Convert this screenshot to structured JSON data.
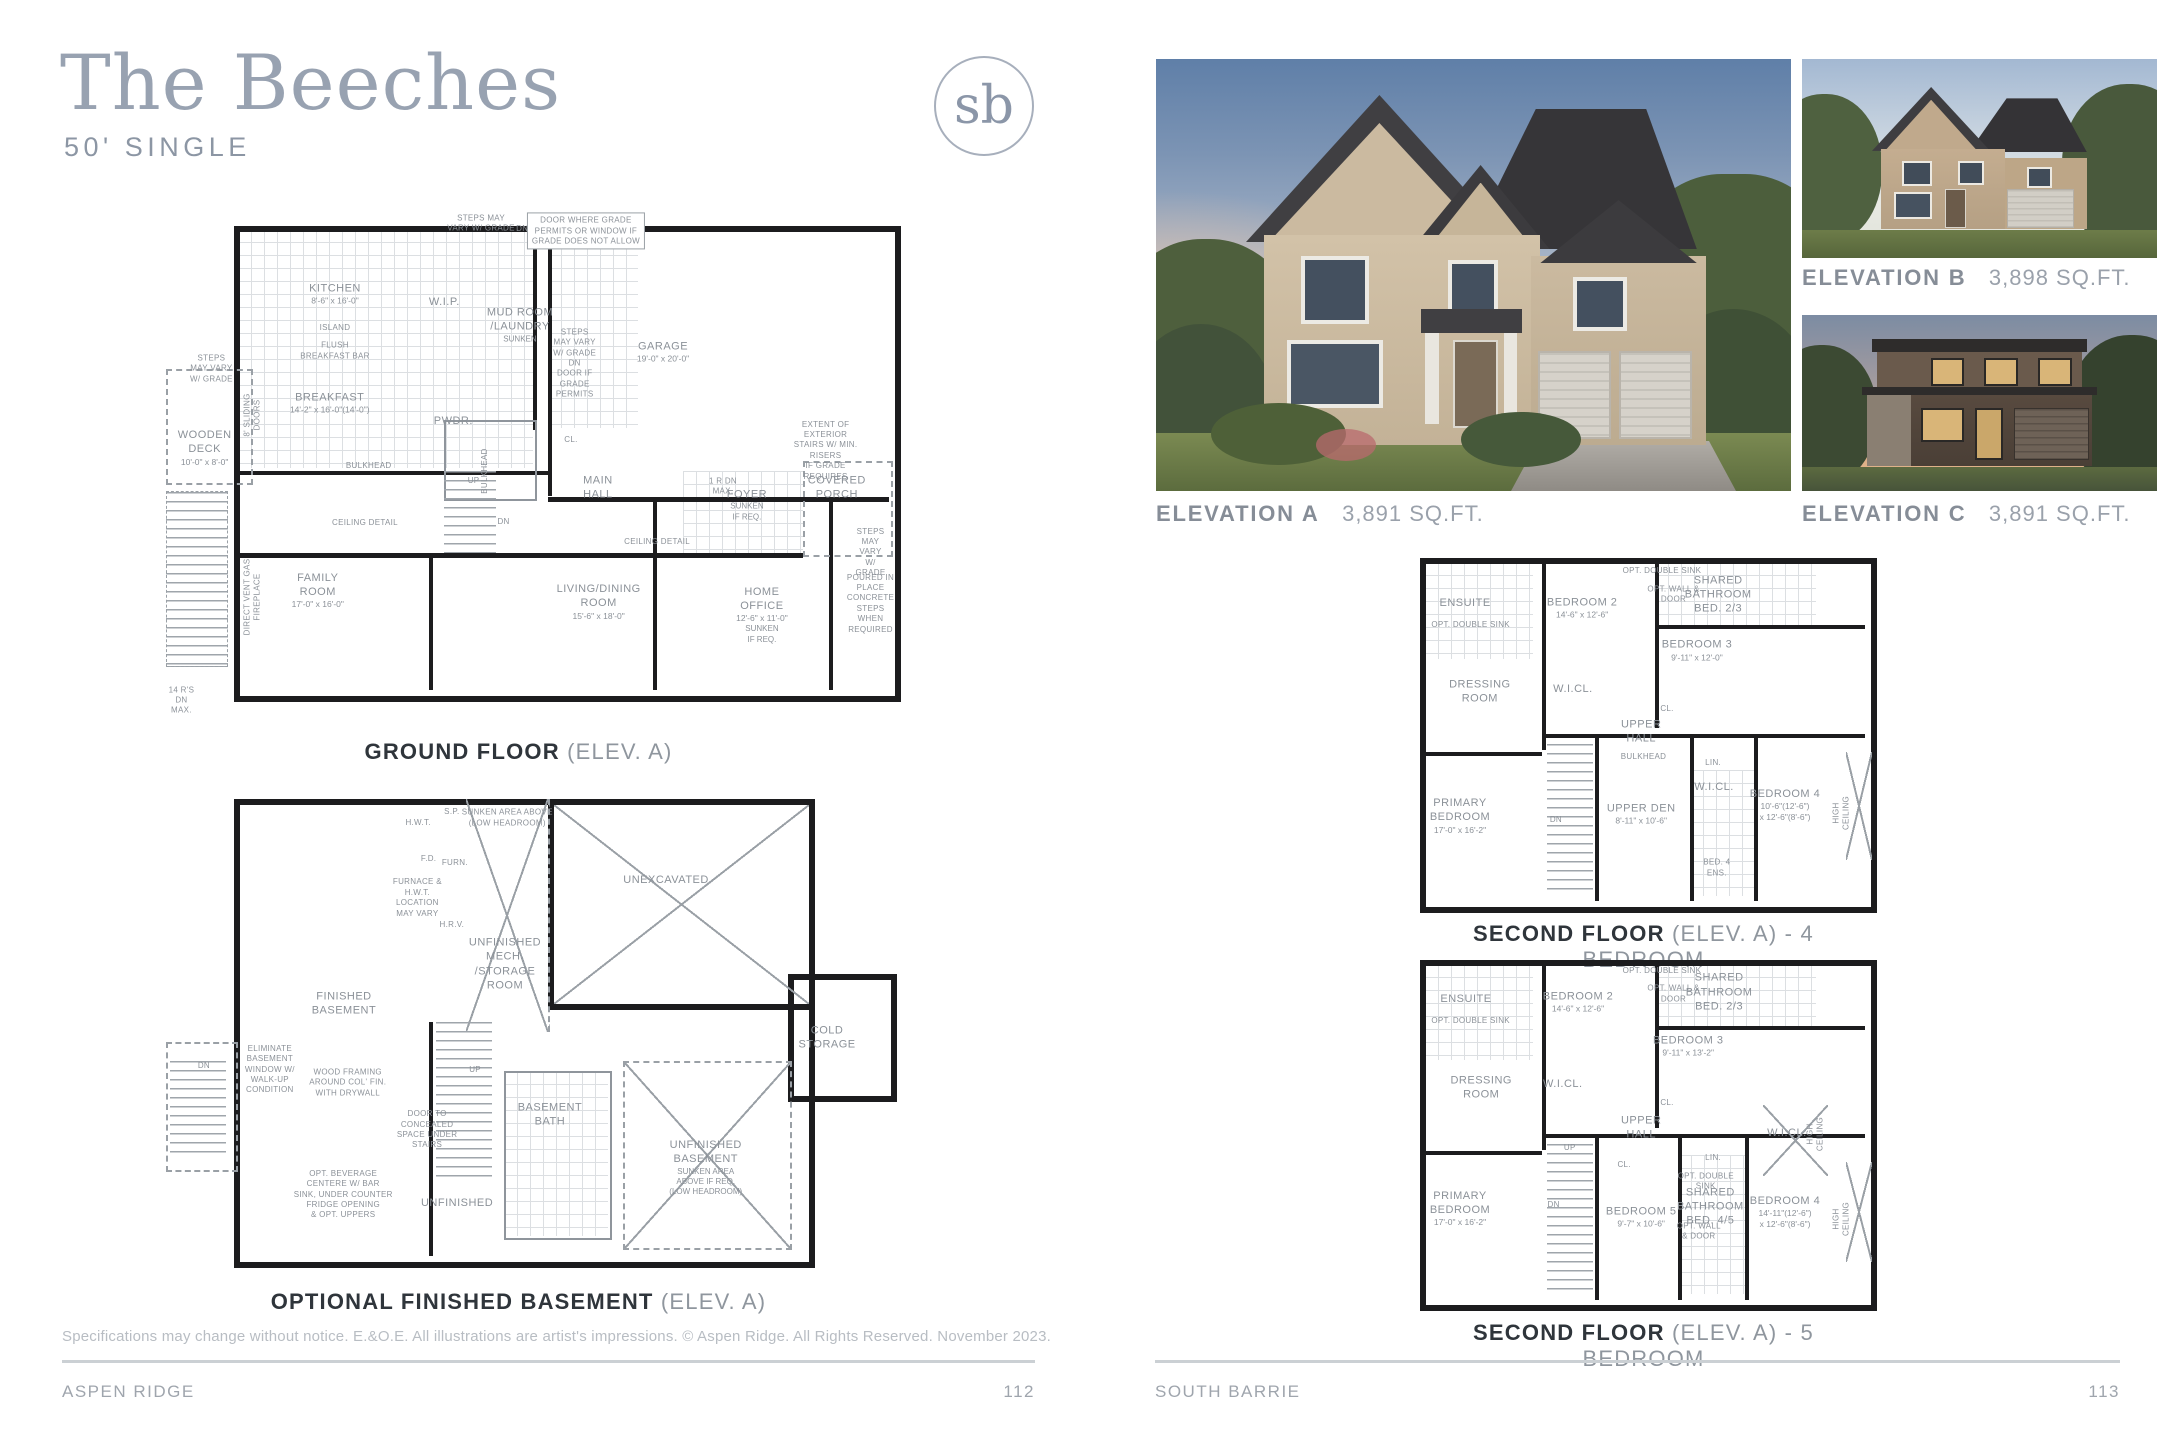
{
  "page": {
    "title": "The Beeches",
    "subtitle": "50' SINGLE",
    "logo_text": "sb",
    "disclaimer": "Specifications may change without notice. E.&O.E. All illustrations are artist's impressions. © Aspen Ridge. All Rights Reserved. November 2023.",
    "footer_left": {
      "label": "ASPEN RIDGE",
      "page": "112"
    },
    "footer_right": {
      "label": "SOUTH BARRIE",
      "page": "113"
    }
  },
  "colors": {
    "accent": "#98a2b1",
    "caption_dark": "#2f353b",
    "caption_gray": "#8f969e",
    "wall": "#1c1c1e"
  },
  "elevations": [
    {
      "id": "A",
      "label": "ELEVATION A",
      "sqft": "3,891 SQ.FT."
    },
    {
      "id": "B",
      "label": "ELEVATION B",
      "sqft": "3,898 SQ.FT."
    },
    {
      "id": "C",
      "label": "ELEVATION C",
      "sqft": "3,891 SQ.FT."
    }
  ],
  "plans": {
    "ground_floor": {
      "caption_bold": "GROUND FLOOR",
      "caption_light": "(ELEV. A)",
      "labels": [
        {
          "t": "KITCHEN",
          "d": "8'-6\" x 16'-0\"",
          "x": 25.5,
          "y": 15.3
        },
        {
          "t": "ISLAND",
          "x": 25.5,
          "y": 22,
          "s": "sm"
        },
        {
          "t": "FLUSH\nBREAKFAST BAR",
          "x": 25.5,
          "y": 26.5,
          "s": "sm"
        },
        {
          "t": "W.I.P.",
          "x": 40.1,
          "y": 16.9
        },
        {
          "t": "MUD ROOM\n/LAUNDRY",
          "n": "SUNKEN",
          "x": 50.2,
          "y": 21.4
        },
        {
          "t": "GARAGE",
          "d": "19'-0\" x 20'-0\"",
          "x": 69.3,
          "y": 26.7
        },
        {
          "t": "BREAKFAST",
          "d": "14'-2\" x 16'-0\"(14'-0\")",
          "x": 24.8,
          "y": 36.7
        },
        {
          "t": "WOODEN\nDECK",
          "d": "10'-0\" x 8'-0\"",
          "x": 8.1,
          "y": 45.5
        },
        {
          "t": "PWDR.",
          "x": 41.3,
          "y": 40.2
        },
        {
          "t": "CL.",
          "x": 57,
          "y": 44,
          "s": "sm"
        },
        {
          "t": "MAIN\nHALL",
          "x": 60.6,
          "y": 53.3
        },
        {
          "t": "FOYER",
          "n": "SUNKEN\nIF REQ.",
          "x": 80.5,
          "y": 56.7
        },
        {
          "t": "COVERED\nPORCH",
          "x": 92.5,
          "y": 53.3
        },
        {
          "t": "FAMILY\nROOM",
          "d": "17'-0\" x 16'-0\"",
          "x": 23.2,
          "y": 73.5
        },
        {
          "t": "LIVING/DINING\nROOM",
          "d": "15'-6\" x 18'-0\"",
          "x": 60.7,
          "y": 75.7
        },
        {
          "t": "HOME\nOFFICE",
          "d": "12'-6\" x 11'-0\"",
          "n": "SUNKEN\nIF REQ.",
          "x": 82.5,
          "y": 78.2
        },
        {
          "t": "STEPS MAY\nVARY W/ GRADE",
          "x": 45,
          "y": 1.5,
          "s": "sm"
        },
        {
          "t": "DN",
          "x": 50.5,
          "y": 2.5,
          "s": "sm"
        },
        {
          "t": "DOOR WHERE GRADE\nPERMITS OR WINDOW IF\nGRADE DOES NOT ALLOW",
          "x": 59,
          "y": 3,
          "s": "sm",
          "b": true
        },
        {
          "t": "STEPS\nMAY VARY\nW/ GRADE",
          "x": 9,
          "y": 30,
          "s": "sm"
        },
        {
          "t": "STEPS\nMAY VARY\nW/ GRADE\nDN\nDOOR IF\nGRADE\nPERMITS",
          "x": 57.5,
          "y": 29,
          "s": "sm"
        },
        {
          "t": "8' SLIDING\nDOORS",
          "x": 14.5,
          "y": 39,
          "s": "sm",
          "r": true
        },
        {
          "t": "BULKHEAD",
          "x": 45.5,
          "y": 50,
          "s": "sm",
          "r": true
        },
        {
          "t": "UP",
          "x": 44,
          "y": 52,
          "s": "sm"
        },
        {
          "t": "DN",
          "x": 48,
          "y": 60,
          "s": "sm"
        },
        {
          "t": "1 R DN\nMAX.",
          "x": 77.3,
          "y": 53.1,
          "s": "sm"
        },
        {
          "t": "CEILING DETAIL",
          "x": 29.5,
          "y": 60.2,
          "s": "sm"
        },
        {
          "t": "CEILING DETAIL",
          "x": 68.5,
          "y": 63.9,
          "s": "sm"
        },
        {
          "t": "DIRECT VENT GAS\nFIREPLACE",
          "x": 14.6,
          "y": 74.7,
          "s": "sm",
          "r": true
        },
        {
          "t": "EXTENT OF EXTERIOR\nSTAIRS W/ MIN. RISERS\nIF GRADE REQUIRES",
          "x": 91,
          "y": 46,
          "s": "sm"
        },
        {
          "t": "STEPS\nMAY VARY\nW/ GRADE",
          "x": 97,
          "y": 66,
          "s": "sm"
        },
        {
          "t": "POURED IN PLACE\nCONCRETE STEPS\nWHEN REQUIRED",
          "x": 97,
          "y": 76,
          "s": "sm"
        },
        {
          "t": "14 R'S\nDN\nMAX.",
          "x": 5,
          "y": 95,
          "s": "sm"
        },
        {
          "t": "BULKHEAD",
          "x": 30,
          "y": 49,
          "s": "sm"
        }
      ]
    },
    "basement": {
      "caption_bold": "OPTIONAL FINISHED BASEMENT",
      "caption_light": "(ELEV. A)",
      "labels": [
        {
          "t": "FINISHED\nBASEMENT",
          "x": 26.7,
          "y": 44.2
        },
        {
          "t": "UNFINISHED\nMECH.\n/STORAGE\nROOM",
          "x": 48.2,
          "y": 36
        },
        {
          "t": "SUNKEN AREA ABOVE\n(LOW HEADROOM)",
          "x": 48.5,
          "y": 6,
          "s": "sm"
        },
        {
          "t": "UNEXCAVATED",
          "x": 69.7,
          "y": 18.7
        },
        {
          "t": "COLD\nSTORAGE",
          "x": 91.2,
          "y": 51.2
        },
        {
          "t": "UNFINISHED\nBASEMENT",
          "n": "SUNKEN AREA\nABOVE IF REQ.\n(LOW HEADROOM)",
          "x": 75,
          "y": 78
        },
        {
          "t": "BASEMENT\nBATH",
          "x": 54.2,
          "y": 67
        },
        {
          "t": "UNFINISHED",
          "x": 41.8,
          "y": 85.2
        },
        {
          "t": "H.W.T.",
          "x": 36.6,
          "y": 7,
          "s": "sm"
        },
        {
          "t": "S.P.",
          "x": 41.1,
          "y": 4.7,
          "s": "sm"
        },
        {
          "t": "F.D.",
          "x": 38,
          "y": 14.4,
          "s": "sm"
        },
        {
          "t": "FURN.",
          "x": 41.5,
          "y": 15.2,
          "s": "sm"
        },
        {
          "t": "FURNACE &\nH.W.T.\nLOCATION\nMAY VARY",
          "x": 36.5,
          "y": 22.5,
          "s": "sm"
        },
        {
          "t": "H.R.V.",
          "x": 41.1,
          "y": 28,
          "s": "sm"
        },
        {
          "t": "UP",
          "x": 44.2,
          "y": 57.8,
          "s": "sm"
        },
        {
          "t": "WOOD FRAMING\nAROUND COL' FIN.\nWITH DRYWALL",
          "x": 27.2,
          "y": 60.5,
          "s": "sm"
        },
        {
          "t": "DOOR TO\nCONCEALED\nSPACE UNDER\nSTAIRS",
          "x": 37.8,
          "y": 70.2,
          "s": "sm"
        },
        {
          "t": "OPT. BEVERAGE\nCENTERE W/ BAR\nSINK, UNDER COUNTER\nFRIDGE OPENING\n& OPT. UPPERS",
          "x": 26.6,
          "y": 83.5,
          "s": "sm"
        },
        {
          "t": "ELIMINATE\nBASEMENT\nWINDOW W/\nWALK-UP\nCONDITION",
          "x": 16.8,
          "y": 57.8,
          "s": "sm"
        },
        {
          "t": "DN",
          "x": 8,
          "y": 57,
          "s": "sm"
        }
      ]
    },
    "second_4br": {
      "caption_bold": "SECOND FLOOR",
      "caption_light": "(ELEV. A) - 4 BEDROOM",
      "labels": [
        {
          "t": "ENSUITE",
          "x": 11.3,
          "y": 13.9
        },
        {
          "t": "OPT. DOUBLE SINK",
          "x": 12.5,
          "y": 20,
          "s": "sm"
        },
        {
          "t": "BEDROOM 2",
          "d": "14'-6\" x 12'-6\"",
          "x": 36.7,
          "y": 15.2
        },
        {
          "t": "OPT. DOUBLE SINK",
          "x": 54,
          "y": 5,
          "s": "sm"
        },
        {
          "t": "OPT. WALL &\nDOOR",
          "x": 56.5,
          "y": 11.5,
          "s": "sm"
        },
        {
          "t": "SHARED\nBATHROOM\nBED. 2/3",
          "x": 66.2,
          "y": 11.5
        },
        {
          "t": "BEDROOM 3",
          "d": "9'-11\" x 12'-0\"",
          "x": 61.6,
          "y": 27
        },
        {
          "t": "DRESSING\nROOM",
          "x": 14.5,
          "y": 38.5
        },
        {
          "t": "W.I.CL.",
          "x": 34.7,
          "y": 37.7
        },
        {
          "t": "CL.",
          "x": 55.1,
          "y": 43.2,
          "s": "sm"
        },
        {
          "t": "UPPER\nHALL",
          "x": 49.5,
          "y": 49.6
        },
        {
          "t": "PRIMARY\nBEDROOM",
          "d": "17'-0\" x 16'-2\"",
          "x": 10.2,
          "y": 72.9
        },
        {
          "t": "UPPER DEN",
          "d": "8'-11\" x 10'-6\"",
          "x": 49.5,
          "y": 72.3
        },
        {
          "t": "LIN.",
          "x": 65.1,
          "y": 58.2,
          "s": "sm"
        },
        {
          "t": "W.I.CL.",
          "x": 65.3,
          "y": 64.8
        },
        {
          "t": "BED. 4\nENS.",
          "x": 65.9,
          "y": 87.3,
          "s": "sm"
        },
        {
          "t": "BEDROOM 4",
          "d": "10'-6\"(12'-6\")\nx 12'-6\"(8'-6\")",
          "x": 80.7,
          "y": 69.8
        },
        {
          "t": "HIGH\nCEILING",
          "x": 93,
          "y": 72,
          "s": "sm",
          "r": true
        },
        {
          "t": "DN",
          "x": 31,
          "y": 74,
          "s": "sm"
        },
        {
          "t": "BULKHEAD",
          "x": 50,
          "y": 56.5,
          "s": "sm"
        }
      ]
    },
    "second_5br": {
      "caption_bold": "SECOND FLOOR",
      "caption_light": "(ELEV. A) - 5 BEDROOM",
      "labels": [
        {
          "t": "ENSUITE",
          "x": 11.5,
          "y": 12.3
        },
        {
          "t": "OPT. DOUBLE SINK",
          "x": 12.5,
          "y": 18.5,
          "s": "sm"
        },
        {
          "t": "BEDROOM 2",
          "d": "14'-6\" x 12'-6\"",
          "x": 35.8,
          "y": 13.2
        },
        {
          "t": "OPT. DOUBLE SINK",
          "x": 54,
          "y": 4.5,
          "s": "sm"
        },
        {
          "t": "OPT. WALL &\nDOOR",
          "x": 56.5,
          "y": 11,
          "s": "sm"
        },
        {
          "t": "SHARED\nBATHROOM\nBED. 2/3",
          "x": 66.4,
          "y": 10.5
        },
        {
          "t": "BEDROOM 3",
          "d": "9'-11\" x 13'-2\"",
          "x": 59.7,
          "y": 25.4
        },
        {
          "t": "DRESSING\nROOM",
          "x": 14.8,
          "y": 37.3
        },
        {
          "t": "W.I.CL.",
          "x": 32.5,
          "y": 36.1
        },
        {
          "t": "CL.",
          "x": 55.1,
          "y": 41.5,
          "s": "sm"
        },
        {
          "t": "UPPER\nHALL",
          "x": 49.5,
          "y": 48.5
        },
        {
          "t": "W.I.CL.",
          "x": 81.1,
          "y": 49.9
        },
        {
          "t": "HIGH CEILING",
          "x": 87.5,
          "y": 50,
          "s": "sm",
          "r": true
        },
        {
          "t": "PRIMARY\nBEDROOM",
          "d": "17'-0\" x 16'-2\"",
          "x": 10.2,
          "y": 71.1
        },
        {
          "t": "CL.",
          "x": 45.8,
          "y": 58.8,
          "s": "sm"
        },
        {
          "t": "BEDROOM 5",
          "d": "9'-7\" x 10'-6\"",
          "x": 49.5,
          "y": 73.4
        },
        {
          "t": "LIN.",
          "x": 65.1,
          "y": 56.9,
          "s": "sm"
        },
        {
          "t": "OPT. DOUBLE\nSINK",
          "x": 63.5,
          "y": 63.5,
          "s": "sm"
        },
        {
          "t": "SHARED\nBATHROOM\nBED. 4/5",
          "x": 64.5,
          "y": 70.5
        },
        {
          "t": "OPT. WALL\n& DOOR",
          "x": 62,
          "y": 77.5,
          "s": "sm"
        },
        {
          "t": "BEDROOM 4",
          "d": "14'-11\"(12'-6\")\nx 12'-6\"(8'-6\")",
          "x": 80.7,
          "y": 72
        },
        {
          "t": "HIGH\nCEILING",
          "x": 93,
          "y": 74,
          "s": "sm",
          "r": true
        },
        {
          "t": "DN",
          "x": 30.5,
          "y": 70,
          "s": "sm"
        },
        {
          "t": "UP",
          "x": 34,
          "y": 54,
          "s": "sm"
        }
      ]
    }
  }
}
